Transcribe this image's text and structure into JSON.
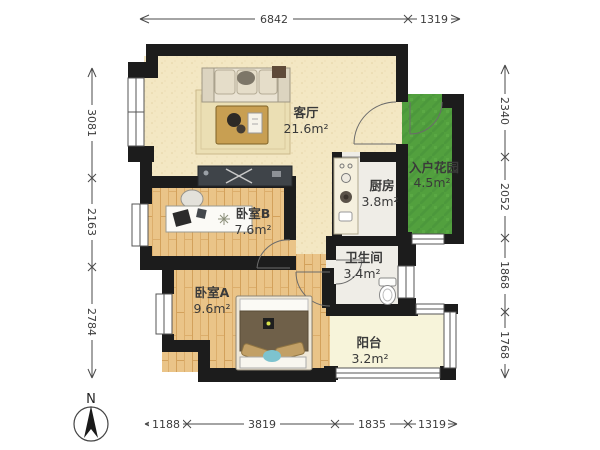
{
  "compass": {
    "label": "N"
  },
  "rooms": {
    "living": {
      "name": "客厅",
      "area": "21.6m²"
    },
    "bedroom_b": {
      "name": "卧室B",
      "area": "7.6m²"
    },
    "bedroom_a": {
      "name": "卧室A",
      "area": "9.6m²"
    },
    "kitchen": {
      "name": "厨房",
      "area": "3.8m²"
    },
    "bathroom": {
      "name": "卫生间",
      "area": "3.4m²"
    },
    "balcony": {
      "name": "阳台",
      "area": "3.2m²"
    },
    "garden": {
      "name": "入户花园",
      "area": "4.5m²"
    }
  },
  "dimensions_mm": {
    "top": [
      "6842",
      "1319"
    ],
    "bottom": [
      "1188",
      "3819",
      "1835",
      "1319"
    ],
    "left": [
      "3081",
      "2163",
      "2784"
    ],
    "right": [
      "2340",
      "2052",
      "1868",
      "1768"
    ]
  },
  "colors": {
    "wall": "#1c1c1c",
    "floor_living": "#f3e7c3",
    "floor_wood": "#eac488",
    "floor_tile": "#efede7",
    "floor_balcony": "#f7f4da",
    "garden_green": "#52a03e",
    "label_text": "#3a3a3a",
    "dimension_text": "#3c3c3c"
  }
}
